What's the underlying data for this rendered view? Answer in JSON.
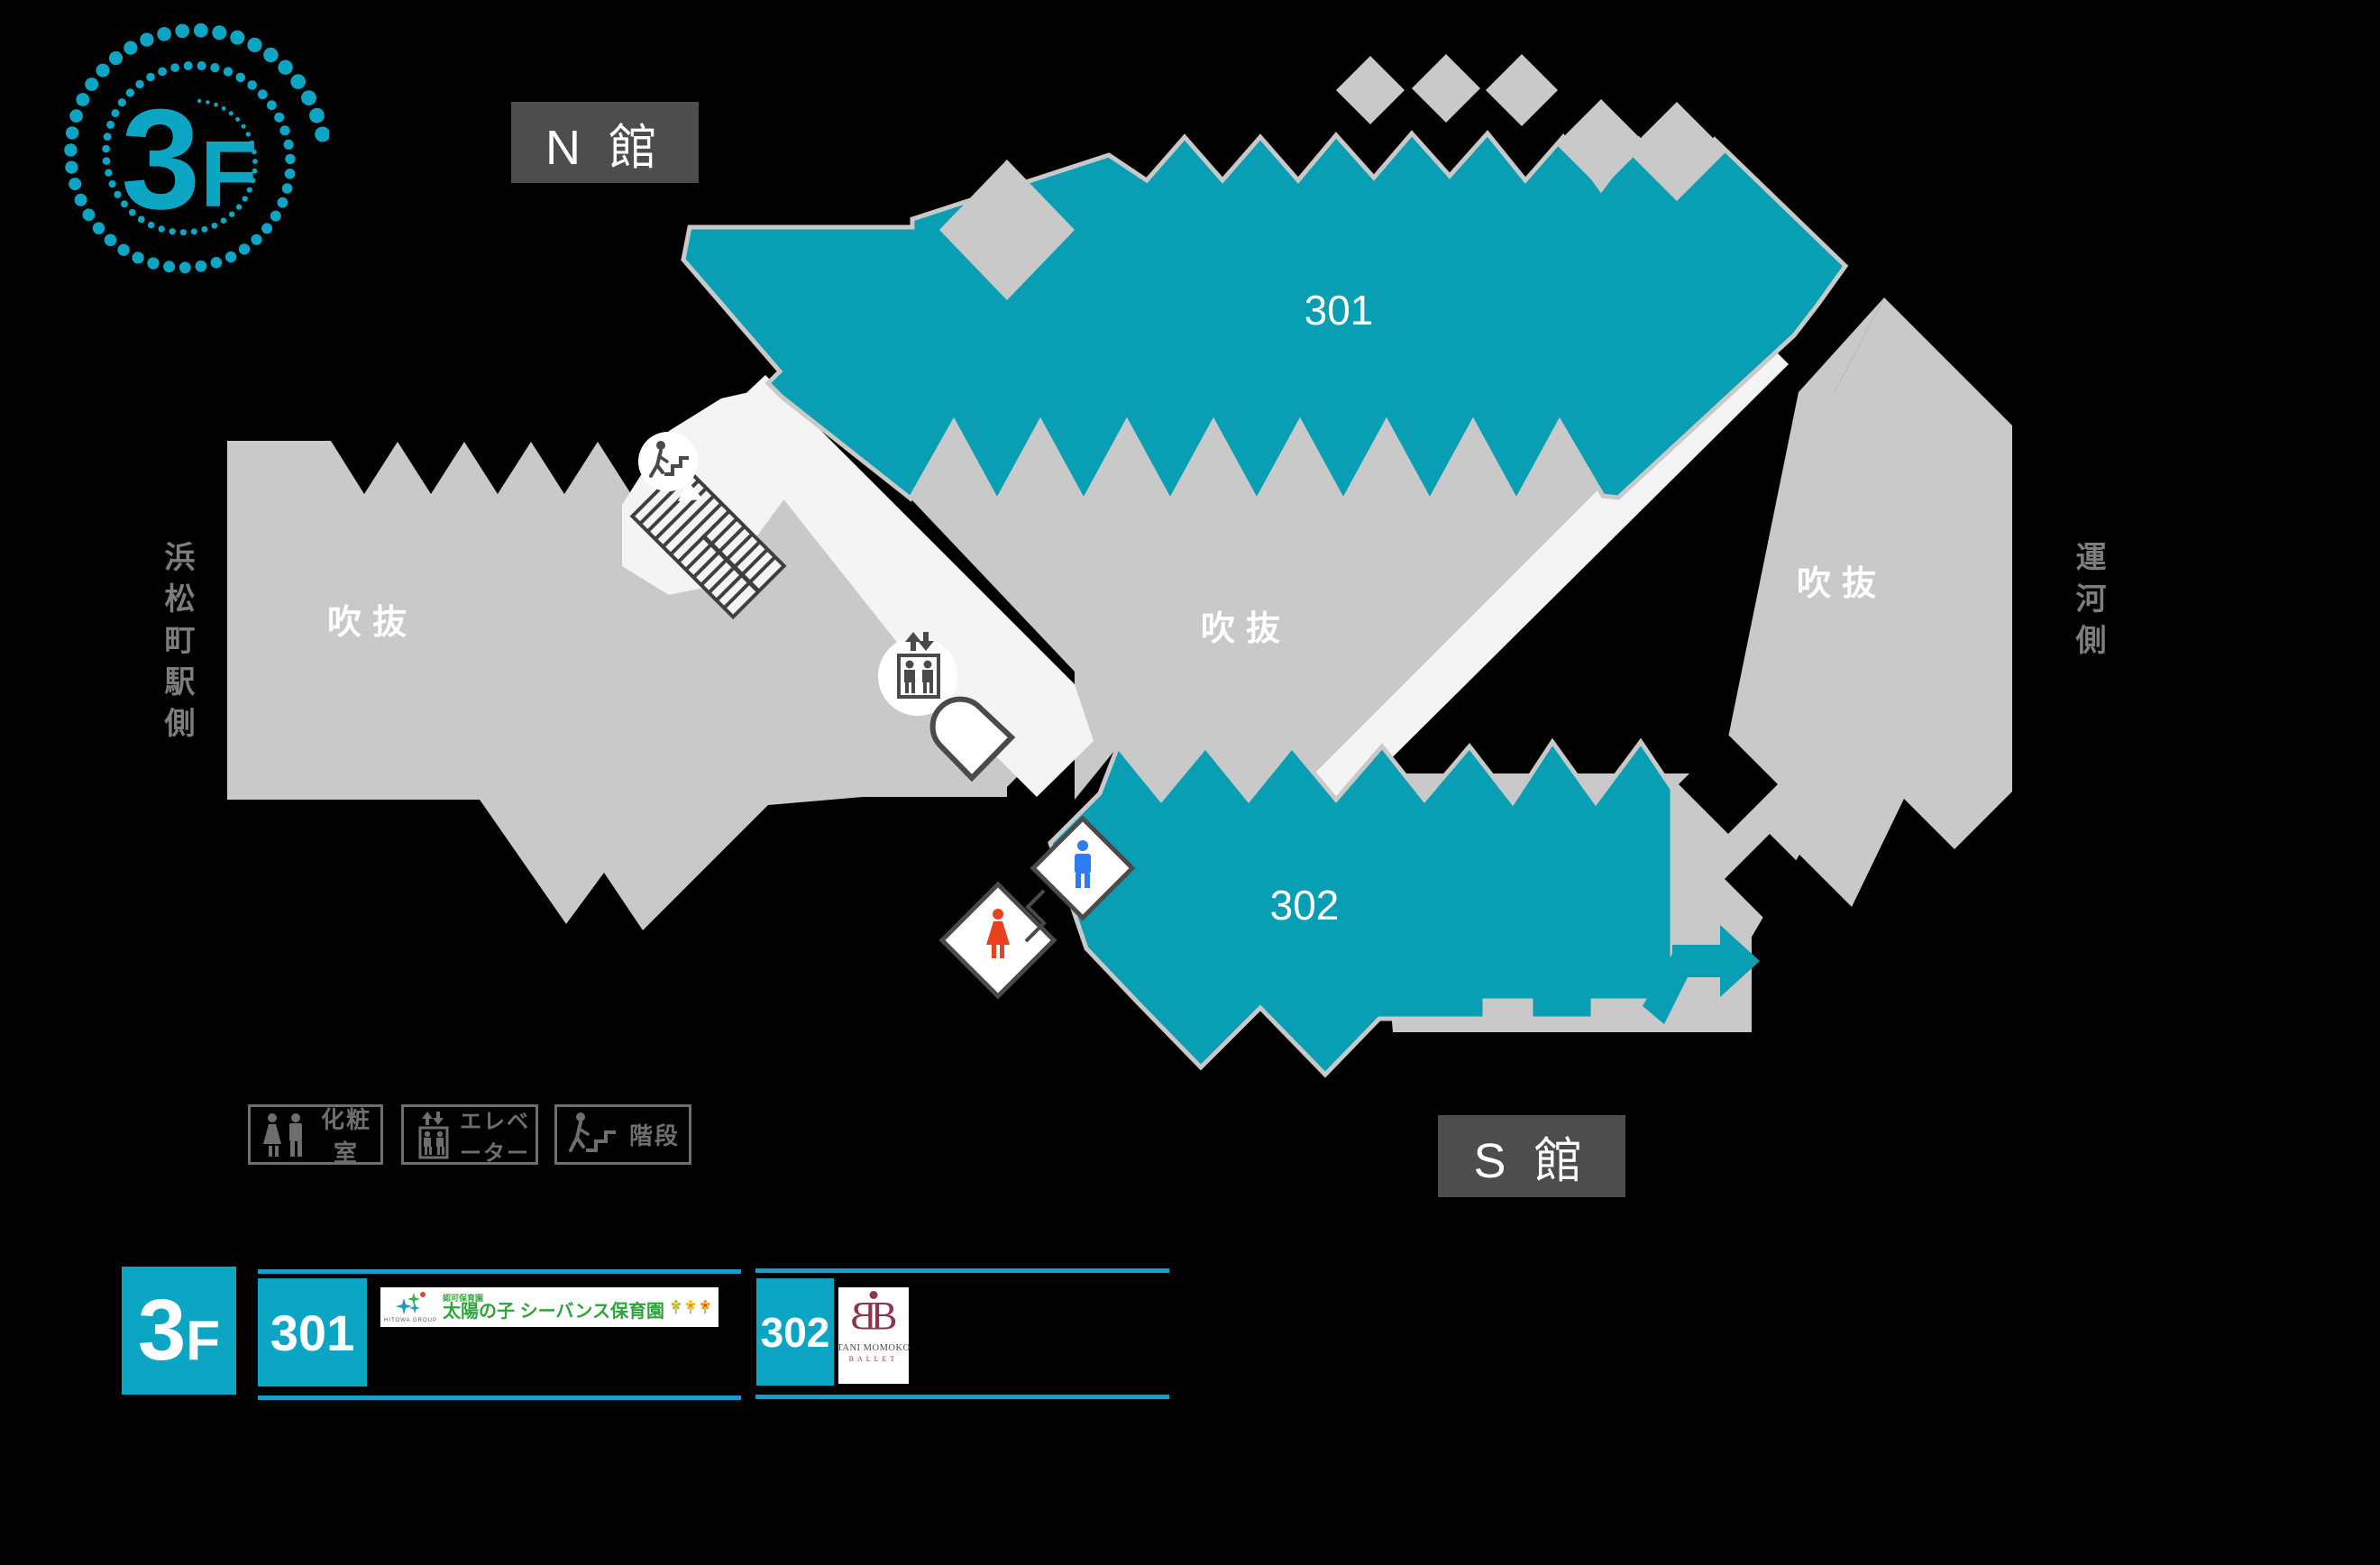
{
  "colors": {
    "teal_map": "#089EB3",
    "teal_box": "#0CA6C4",
    "teal_line": "#149FCC",
    "gray_map": "#C9C9C9",
    "corridor": "#F4F4F4",
    "dark_box": "#4D4D4D",
    "legend_gray": "#6E6E6E",
    "side_text_gray": "#7D7D7D",
    "icon_dark": "#4A4A4A",
    "man_blue": "#2F7BF2",
    "woman_red": "#E8421F",
    "ballet_maroon": "#8E3549",
    "nursery_green": "#2FA43C"
  },
  "floor_badge": {
    "number": "3",
    "suffix": "F"
  },
  "buildings": {
    "north": "N 館",
    "south": "S 館"
  },
  "map": {
    "room_301": "301",
    "room_302": "302",
    "atrium_left": "吹抜",
    "atrium_center": "吹抜",
    "atrium_right": "吹抜",
    "side_left": "浜松町駅側",
    "side_right": "運河側"
  },
  "legend": {
    "restroom": "化粧室",
    "elevator": "エレベーター",
    "stairs": "階段"
  },
  "directory": {
    "floor_number": "3",
    "floor_suffix": "F",
    "entries": [
      {
        "room": "301",
        "logo_group": "HITOWA GROUP",
        "logo_license": "認可保育園",
        "logo_name": "太陽の子 シーバンス保育園"
      },
      {
        "room": "302",
        "logo_monogram": "B",
        "logo_name": "TANI MOMOKO",
        "logo_subname": "BALLET"
      }
    ]
  }
}
